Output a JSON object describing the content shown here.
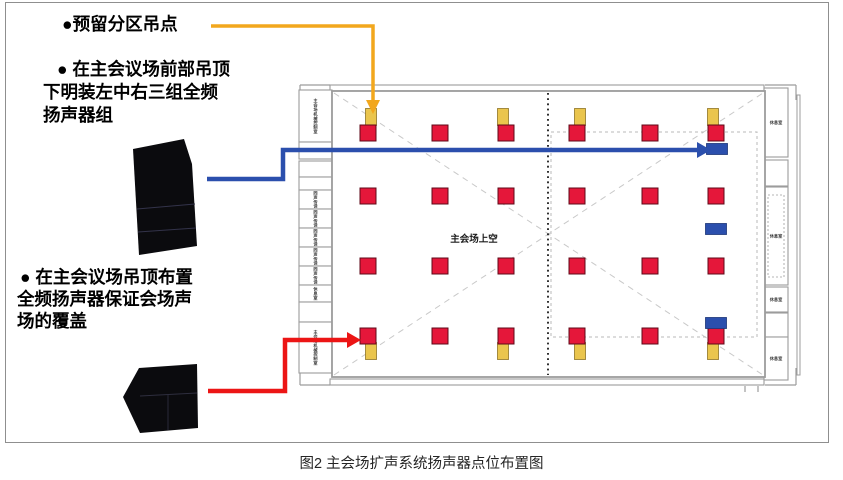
{
  "figure": {
    "caption": "图2 主会场扩声系统扬声器点位布置图"
  },
  "notes": [
    {
      "lines": [
        "●预留分区吊点"
      ]
    },
    {
      "lines": [
        "● 在主会议场前部吊顶",
        "下明装左中右三组全频",
        "扬声器组"
      ]
    },
    {
      "lines": [
        "● 在主会议场吊顶布置",
        "全频扬声器保证会场声",
        "场的覆盖"
      ]
    }
  ],
  "colors": {
    "red_speaker": "#e5173a",
    "red_speaker_border": "#5f0a18",
    "yellow_point": "#eac54d",
    "yellow_point_border": "#8f7426",
    "blue_speaker": "#2b4fad",
    "blue_speaker_border": "#1c3577",
    "arrow_orange": "#f2a71d",
    "arrow_blue": "#2b4fad",
    "arrow_red": "#ec1515",
    "wall": "#9c9c9c",
    "dash": "#c9c9c9",
    "black_speaker": "#0b0b0e"
  },
  "plan": {
    "center_label": "主会场上空",
    "red_speakers": {
      "cols": [
        368,
        440,
        506,
        577,
        650,
        716
      ],
      "rows": [
        133,
        196,
        266,
        336
      ],
      "size": 16
    },
    "yellow_points": {
      "cols": [
        371,
        503,
        580,
        713
      ],
      "rows": [
        117,
        351
      ],
      "w": 11,
      "h": 17
    },
    "blue_speakers": {
      "points": [
        [
          717,
          149
        ],
        [
          716,
          229
        ],
        [
          716,
          323
        ]
      ],
      "w": 21,
      "h": 11
    },
    "left_rooms": [
      {
        "y": 90,
        "h": 52,
        "label": "主会场机械控制室"
      },
      {
        "y": 142,
        "h": 17,
        "label": ""
      },
      {
        "y": 161,
        "h": 16,
        "label": ""
      },
      {
        "y": 177,
        "h": 13,
        "label": ""
      },
      {
        "y": 190,
        "h": 19,
        "label": "同声传译"
      },
      {
        "y": 209,
        "h": 19,
        "label": "同声传译"
      },
      {
        "y": 228,
        "h": 19,
        "label": "同声传译"
      },
      {
        "y": 247,
        "h": 19,
        "label": "同声传译"
      },
      {
        "y": 266,
        "h": 19,
        "label": "同声传译"
      },
      {
        "y": 285,
        "h": 17,
        "label": "休息室"
      },
      {
        "y": 302,
        "h": 20,
        "label": ""
      },
      {
        "y": 322,
        "h": 51,
        "label": "主会场机械控制室"
      }
    ],
    "right_rooms": [
      {
        "y": 88,
        "h": 69,
        "label": "休息室"
      },
      {
        "y": 160,
        "h": 26,
        "label": ""
      },
      {
        "y": 187,
        "h": 98,
        "label": "休息室",
        "inner": true
      },
      {
        "y": 287,
        "h": 25,
        "label": "休息室"
      },
      {
        "y": 313,
        "h": 24,
        "label": ""
      },
      {
        "y": 337,
        "h": 43,
        "label": "休息室"
      }
    ]
  }
}
